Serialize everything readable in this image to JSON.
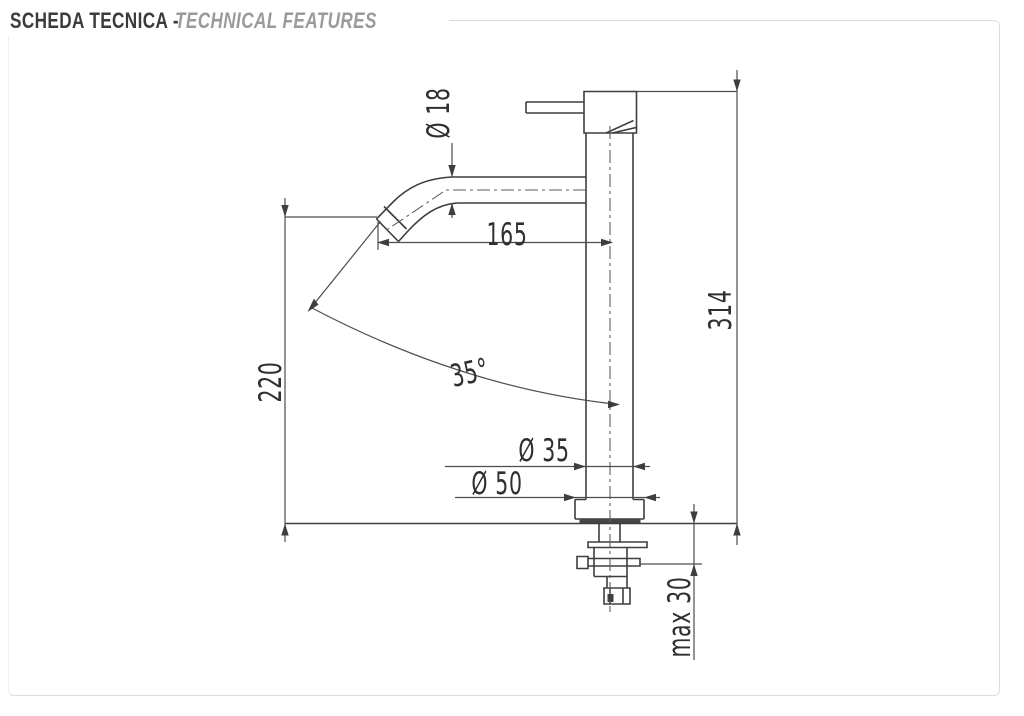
{
  "header": {
    "title_primary": "SCHEDA TECNICA -",
    "title_secondary": "TECHNICAL FEATURES"
  },
  "drawing": {
    "subject": "single-lever tall basin mixer tap, side elevation with installation hardware",
    "dimensions": {
      "spout_tube_diameter": "Ø 18",
      "spout_reach": "165",
      "total_height": "314",
      "spout_outlet_height": "220",
      "water_stream_angle": "35°",
      "body_diameter": "Ø 35",
      "base_diameter": "Ø 50",
      "max_counter_thickness": "max 30"
    }
  },
  "colors": {
    "background": "#ffffff",
    "object_lines": "#3e3e3e",
    "dimension_lines": "#4d4d4d",
    "dimension_text": "#2f2f2f",
    "title_primary": "#3b3b3b",
    "title_secondary": "#9a9a9a",
    "frame_border": "#dcdcdc"
  }
}
